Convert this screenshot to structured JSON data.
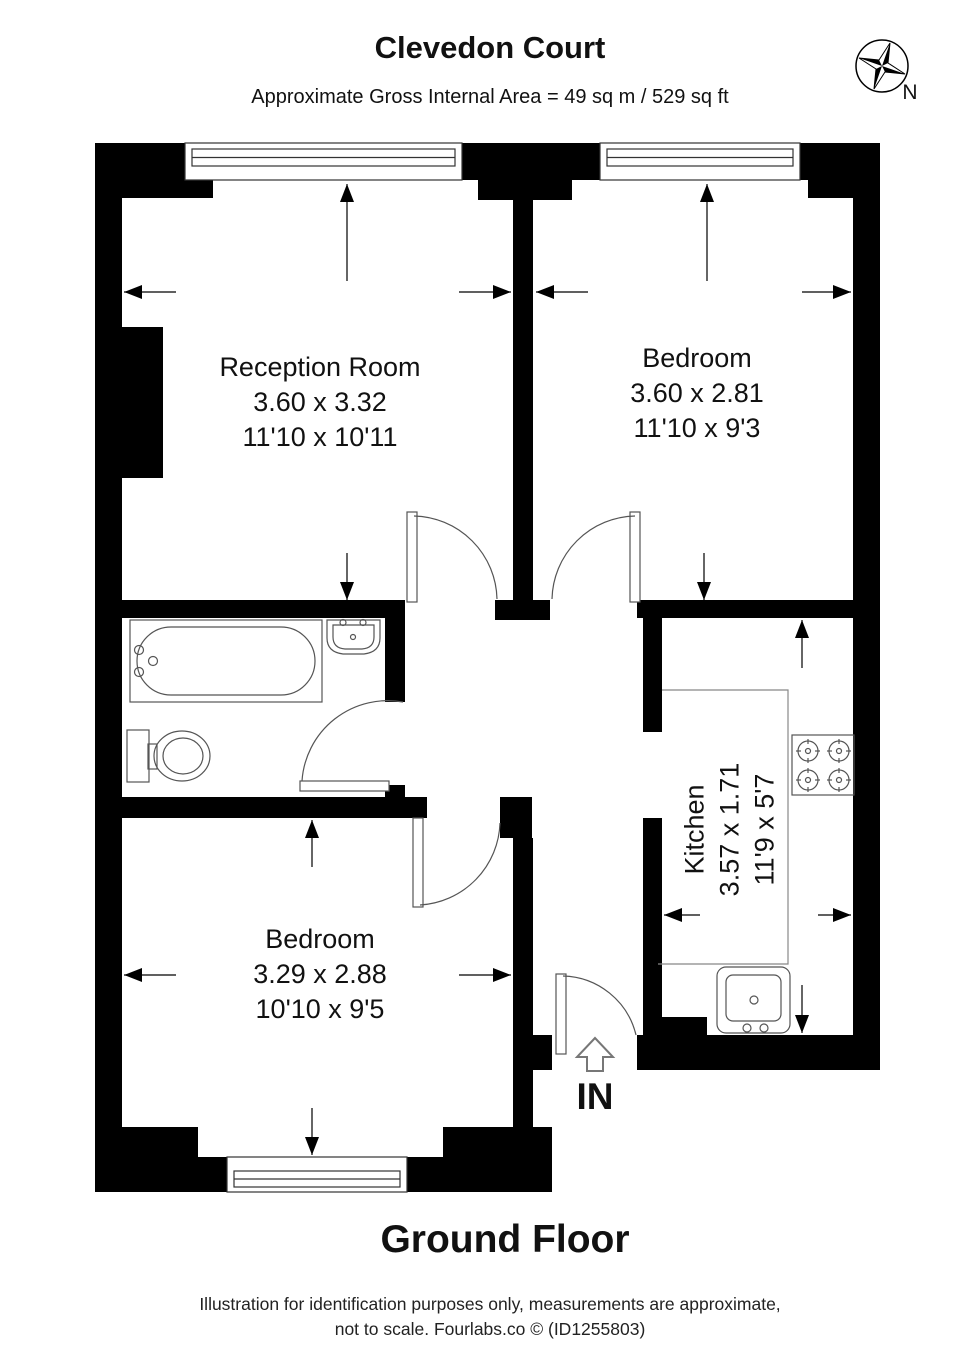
{
  "header": {
    "title": "Clevedon Court",
    "subtitle": "Approximate Gross Internal Area = 49 sq m / 529 sq ft"
  },
  "compass": {
    "north_label": "N"
  },
  "rooms": [
    {
      "name": "Reception Room",
      "metric": "3.60 x 3.32",
      "imperial": "11'10 x 10'11"
    },
    {
      "name": "Bedroom",
      "metric": "3.60 x 2.81",
      "imperial": "11'10 x 9'3"
    },
    {
      "name": "Kitchen",
      "metric": "3.57 x 1.71",
      "imperial": "11'9 x 5'7"
    },
    {
      "name": "Bedroom",
      "metric": "3.29 x 2.88",
      "imperial": "10'10 x 9'5"
    }
  ],
  "entrance": {
    "label": "IN"
  },
  "floor": {
    "label": "Ground Floor"
  },
  "footer": {
    "line1": "Illustration for identification purposes only, measurements are approximate,",
    "line2": "not to scale. Fourlabs.co © (ID1255803)"
  },
  "colors": {
    "wall": "#000000",
    "line": "#333333",
    "fixture": "#555555"
  }
}
